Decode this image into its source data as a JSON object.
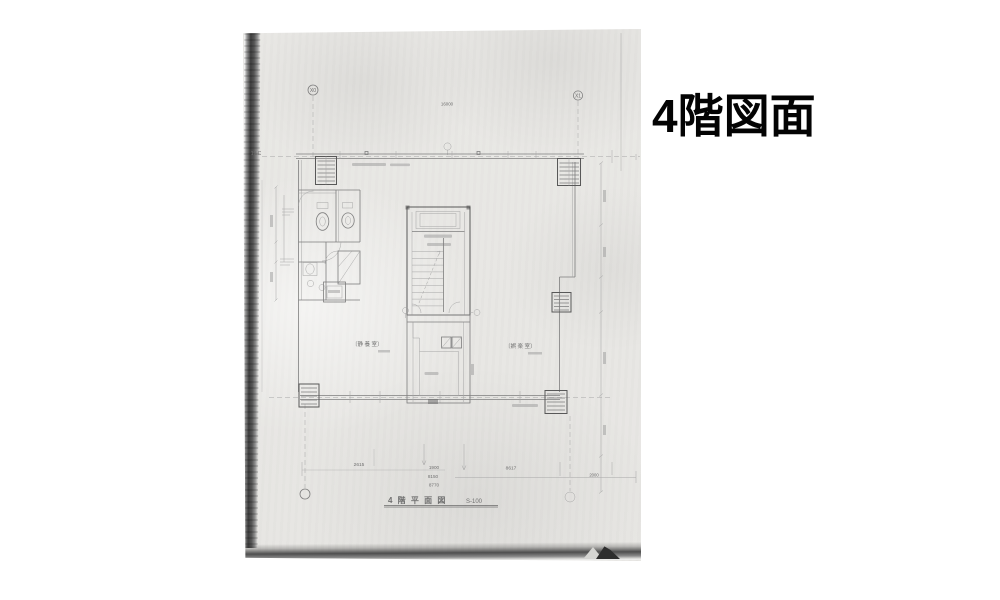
{
  "caption": {
    "title": "4階図面"
  },
  "plan": {
    "title": "4 階 平 面 図",
    "scale": "S-100",
    "grid": {
      "x_left": "X0",
      "x_right": "X1",
      "edge_mark": "19 C"
    },
    "rooms": {
      "left": "〔静 養 室〕",
      "right": "〔娯 楽 室〕"
    },
    "dims": {
      "top": "16000",
      "d2615": "2615",
      "d8617": "8617",
      "d1900": "1900",
      "d8150": "8150",
      "d8770": "8770",
      "d2000": "2000"
    }
  }
}
